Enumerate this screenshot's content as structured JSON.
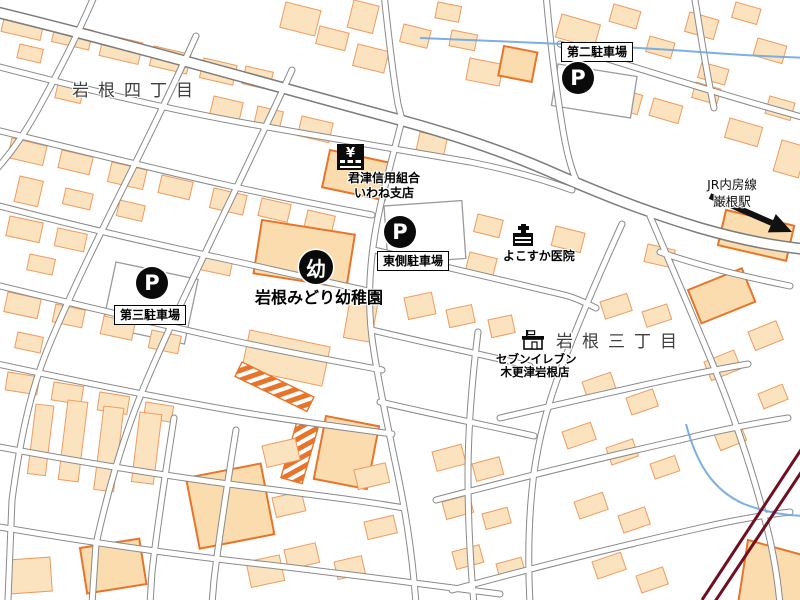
{
  "map_labels": {
    "district_1": "岩根四丁目",
    "district_2": "岩根三丁目",
    "parking_2": "第二駐車場",
    "parking_east": "東側駐車場",
    "parking_3": "第三駐車場",
    "bank_line1": "君津信用組合",
    "bank_line2": "いわね支店",
    "clinic": "よこすか医院",
    "kindergarten": "岩根みどり幼稚園",
    "store_line1": "セブンイレブン",
    "store_line2": "木更津岩根店",
    "rail_line": "JR内房線",
    "station": "巌根駅"
  },
  "icon_chars": {
    "parking": "P",
    "kindergarten": "幼",
    "bank": "¥"
  },
  "colors": {
    "building_fill": "#FBE3BF",
    "building_stroke": "#EE9B5F",
    "building_bold_stroke": "#E8742A",
    "road_casing": "#8A8A8A",
    "railway": "#6E1022",
    "stream": "#6FA6DF",
    "poi_icon_bg": "#0A0A0A",
    "district_text": "#3F3F3F"
  }
}
